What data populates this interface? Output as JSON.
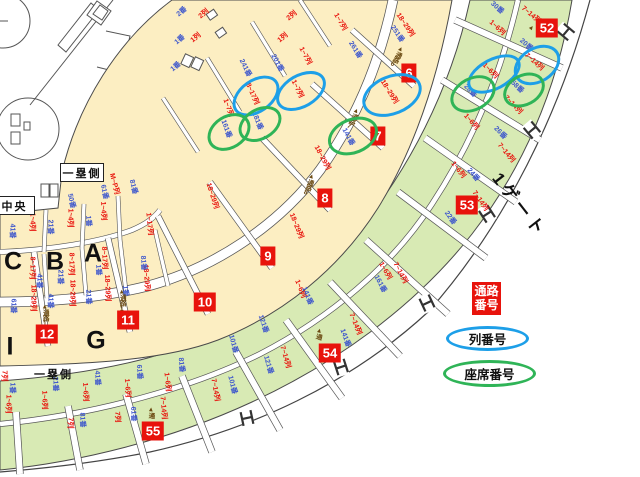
{
  "legend": {
    "aisle_label": "通路番号",
    "row_label": "列番号",
    "seat_label": "座席番号"
  },
  "gate_label": "1ゲート",
  "area_labels": {
    "first_base_upper": "一塁側",
    "first_base_lower": "一塁側",
    "center": "中央"
  },
  "section_letters": [
    {
      "t": "C",
      "x": 13,
      "y": 262
    },
    {
      "t": "B",
      "x": 55,
      "y": 262
    },
    {
      "t": "A",
      "x": 93,
      "y": 254
    },
    {
      "t": "I",
      "x": 10,
      "y": 347
    },
    {
      "t": "G",
      "x": 96,
      "y": 341
    }
  ],
  "aisle_badges": [
    {
      "t": "6",
      "x": 409,
      "y": 73
    },
    {
      "t": "7",
      "x": 378,
      "y": 136
    },
    {
      "t": "8",
      "x": 325,
      "y": 198
    },
    {
      "t": "9",
      "x": 268,
      "y": 256
    },
    {
      "t": "10",
      "x": 205,
      "y": 302
    },
    {
      "t": "11",
      "x": 128,
      "y": 320
    },
    {
      "t": "12",
      "x": 47,
      "y": 334
    },
    {
      "t": "52",
      "x": 547,
      "y": 28
    },
    {
      "t": "53",
      "x": 467,
      "y": 205
    },
    {
      "t": "54",
      "x": 330,
      "y": 353
    },
    {
      "t": "55",
      "x": 153,
      "y": 431
    }
  ],
  "highlight_ovals": [
    {
      "c": "blue",
      "x": 253,
      "y": 93,
      "w": 46,
      "h": 28,
      "r": -35
    },
    {
      "c": "blue",
      "x": 298,
      "y": 88,
      "w": 48,
      "h": 28,
      "r": -30
    },
    {
      "c": "blue",
      "x": 389,
      "y": 92,
      "w": 56,
      "h": 34,
      "r": -22
    },
    {
      "c": "blue",
      "x": 491,
      "y": 71,
      "w": 52,
      "h": 26,
      "r": -28
    },
    {
      "c": "blue",
      "x": 534,
      "y": 62,
      "w": 44,
      "h": 30,
      "r": -32
    },
    {
      "c": "green",
      "x": 226,
      "y": 129,
      "w": 40,
      "h": 28,
      "r": -32
    },
    {
      "c": "green",
      "x": 257,
      "y": 121,
      "w": 40,
      "h": 26,
      "r": -30
    },
    {
      "c": "green",
      "x": 350,
      "y": 133,
      "w": 46,
      "h": 30,
      "r": -22
    },
    {
      "c": "green",
      "x": 470,
      "y": 91,
      "w": 42,
      "h": 28,
      "r": -28
    },
    {
      "c": "green",
      "x": 521,
      "y": 87,
      "w": 38,
      "h": 26,
      "r": -28
    }
  ],
  "labels": [
    {
      "t": "1~4列",
      "x": 32,
      "y": 222,
      "r": 90,
      "k": "r"
    },
    {
      "t": "1~4列",
      "x": 70,
      "y": 218,
      "r": 90,
      "k": "r"
    },
    {
      "t": "1~4列",
      "x": 103,
      "y": 211,
      "r": 88,
      "k": "r"
    },
    {
      "t": "8~17列",
      "x": 32,
      "y": 268,
      "r": 90,
      "k": "r"
    },
    {
      "t": "8~17列",
      "x": 71,
      "y": 264,
      "r": 90,
      "k": "r"
    },
    {
      "t": "8~17列",
      "x": 104,
      "y": 258,
      "r": 88,
      "k": "r"
    },
    {
      "t": "18~29列",
      "x": 33,
      "y": 298,
      "r": 90,
      "k": "r"
    },
    {
      "t": "18~29列",
      "x": 72,
      "y": 293,
      "r": 90,
      "k": "r"
    },
    {
      "t": "18~29列",
      "x": 107,
      "y": 288,
      "r": 88,
      "k": "r"
    },
    {
      "t": "18~29列",
      "x": 146,
      "y": 278,
      "r": 86,
      "k": "r"
    },
    {
      "t": "M~P列",
      "x": 114,
      "y": 184,
      "r": 76,
      "k": "r"
    },
    {
      "t": "1~17列",
      "x": 149,
      "y": 224,
      "r": 84,
      "k": "r"
    },
    {
      "t": "1~7列",
      "x": 228,
      "y": 108,
      "r": 70,
      "k": "r"
    },
    {
      "t": "8~17列",
      "x": 252,
      "y": 94,
      "r": 66,
      "k": "r"
    },
    {
      "t": "1~7列",
      "x": 297,
      "y": 89,
      "r": 64,
      "k": "r"
    },
    {
      "t": "18~29列",
      "x": 389,
      "y": 92,
      "r": 58,
      "k": "r"
    },
    {
      "t": "18~29列",
      "x": 322,
      "y": 158,
      "r": 62,
      "k": "r"
    },
    {
      "t": "18~29列",
      "x": 296,
      "y": 226,
      "r": 68,
      "k": "r"
    },
    {
      "t": "18~29列",
      "x": 212,
      "y": 196,
      "r": 72,
      "k": "r"
    },
    {
      "t": "1~7列",
      "x": 340,
      "y": 22,
      "r": 60,
      "k": "r"
    },
    {
      "t": "1~7列",
      "x": 305,
      "y": 56,
      "r": 62,
      "k": "r"
    },
    {
      "t": "18~29列",
      "x": 405,
      "y": 25,
      "r": 56,
      "k": "r"
    },
    {
      "t": "1~6列",
      "x": 497,
      "y": 28,
      "r": 42,
      "k": "r"
    },
    {
      "t": "1~6列",
      "x": 490,
      "y": 71,
      "r": 45,
      "k": "r"
    },
    {
      "t": "1~6列",
      "x": 471,
      "y": 122,
      "r": 48,
      "k": "r"
    },
    {
      "t": "1~6列",
      "x": 458,
      "y": 170,
      "r": 52,
      "k": "r"
    },
    {
      "t": "1~6列",
      "x": 385,
      "y": 271,
      "r": 60,
      "k": "r"
    },
    {
      "t": "1~6列",
      "x": 300,
      "y": 289,
      "r": 68,
      "k": "r"
    },
    {
      "t": "1~6列",
      "x": 167,
      "y": 382,
      "r": 84,
      "k": "r"
    },
    {
      "t": "1~6列",
      "x": 127,
      "y": 388,
      "r": 86,
      "k": "r"
    },
    {
      "t": "1~6列",
      "x": 85,
      "y": 392,
      "r": 88,
      "k": "r"
    },
    {
      "t": "1~6列",
      "x": 44,
      "y": 400,
      "r": 89,
      "k": "r"
    },
    {
      "t": "1~6列",
      "x": 8,
      "y": 404,
      "r": 90,
      "k": "r"
    },
    {
      "t": "7~14列",
      "x": 531,
      "y": 15,
      "r": 40,
      "k": "r"
    },
    {
      "t": "7~14列",
      "x": 534,
      "y": 62,
      "r": 42,
      "k": "r"
    },
    {
      "t": "7~14列",
      "x": 513,
      "y": 105,
      "r": 46,
      "k": "r"
    },
    {
      "t": "7~14列",
      "x": 506,
      "y": 153,
      "r": 50,
      "k": "r"
    },
    {
      "t": "7~14列",
      "x": 480,
      "y": 201,
      "r": 55,
      "k": "r"
    },
    {
      "t": "7~14列",
      "x": 400,
      "y": 273,
      "r": 62,
      "k": "r"
    },
    {
      "t": "7~14列",
      "x": 355,
      "y": 324,
      "r": 68,
      "k": "r"
    },
    {
      "t": "7~14列",
      "x": 285,
      "y": 357,
      "r": 74,
      "k": "r"
    },
    {
      "t": "7~14列",
      "x": 215,
      "y": 390,
      "r": 80,
      "k": "r"
    },
    {
      "t": "7~14列",
      "x": 163,
      "y": 408,
      "r": 85,
      "k": "r"
    },
    {
      "t": "7列",
      "x": 70,
      "y": 423,
      "r": 90,
      "k": "r"
    },
    {
      "t": "7列",
      "x": 117,
      "y": 417,
      "r": 88,
      "k": "r"
    },
    {
      "t": "7列",
      "x": 4,
      "y": 376,
      "r": 90,
      "k": "r"
    },
    {
      "t": "41番",
      "x": 12,
      "y": 231,
      "r": 90,
      "k": "b"
    },
    {
      "t": "21番",
      "x": 50,
      "y": 227,
      "r": 90,
      "k": "b"
    },
    {
      "t": "1番",
      "x": 88,
      "y": 221,
      "r": 88,
      "k": "b"
    },
    {
      "t": "50番",
      "x": 71,
      "y": 201,
      "r": 78,
      "k": "b"
    },
    {
      "t": "41番",
      "x": 39,
      "y": 281,
      "r": 90,
      "k": "b"
    },
    {
      "t": "21番",
      "x": 60,
      "y": 277,
      "r": 90,
      "k": "b"
    },
    {
      "t": "1番",
      "x": 98,
      "y": 270,
      "r": 88,
      "k": "b"
    },
    {
      "t": "81番",
      "x": 143,
      "y": 263,
      "r": 86,
      "k": "b"
    },
    {
      "t": "61番",
      "x": 104,
      "y": 192,
      "r": 78,
      "k": "b"
    },
    {
      "t": "81番",
      "x": 133,
      "y": 187,
      "r": 76,
      "k": "b"
    },
    {
      "t": "61番",
      "x": 13,
      "y": 306,
      "r": 90,
      "k": "b"
    },
    {
      "t": "41番",
      "x": 50,
      "y": 301,
      "r": 90,
      "k": "b"
    },
    {
      "t": "21番",
      "x": 88,
      "y": 297,
      "r": 88,
      "k": "b"
    },
    {
      "t": "1番",
      "x": 125,
      "y": 291,
      "r": 86,
      "k": "b"
    },
    {
      "t": "2番",
      "x": 182,
      "y": 12,
      "r": -40,
      "k": "b"
    },
    {
      "t": "1番",
      "x": 180,
      "y": 40,
      "r": -40,
      "k": "b"
    },
    {
      "t": "1番",
      "x": 176,
      "y": 67,
      "r": -40,
      "k": "b"
    },
    {
      "t": "1列",
      "x": 196,
      "y": 38,
      "r": -40,
      "k": "r"
    },
    {
      "t": "2列",
      "x": 204,
      "y": 14,
      "r": -40,
      "k": "r"
    },
    {
      "t": "1列",
      "x": 283,
      "y": 38,
      "r": -40,
      "k": "r"
    },
    {
      "t": "2列",
      "x": 292,
      "y": 16,
      "r": -40,
      "k": "r"
    },
    {
      "t": "201番",
      "x": 277,
      "y": 63,
      "r": 62,
      "k": "b"
    },
    {
      "t": "241番",
      "x": 245,
      "y": 68,
      "r": 64,
      "k": "b"
    },
    {
      "t": "261番",
      "x": 355,
      "y": 50,
      "r": 58,
      "k": "b"
    },
    {
      "t": "251番",
      "x": 397,
      "y": 34,
      "r": 56,
      "k": "b"
    },
    {
      "t": "161番",
      "x": 226,
      "y": 129,
      "r": 70,
      "k": "b"
    },
    {
      "t": "181番",
      "x": 257,
      "y": 121,
      "r": 68,
      "k": "b"
    },
    {
      "t": "141番",
      "x": 348,
      "y": 137,
      "r": 62,
      "k": "b"
    },
    {
      "t": "30番",
      "x": 497,
      "y": 8,
      "r": 42,
      "k": "b"
    },
    {
      "t": "20番",
      "x": 526,
      "y": 45,
      "r": 42,
      "k": "b"
    },
    {
      "t": "28番",
      "x": 470,
      "y": 91,
      "r": 46,
      "k": "b"
    },
    {
      "t": "58番",
      "x": 517,
      "y": 87,
      "r": 44,
      "k": "b"
    },
    {
      "t": "26番",
      "x": 500,
      "y": 133,
      "r": 46,
      "k": "b"
    },
    {
      "t": "24番",
      "x": 473,
      "y": 175,
      "r": 50,
      "k": "b"
    },
    {
      "t": "22番",
      "x": 450,
      "y": 218,
      "r": 54,
      "k": "b"
    },
    {
      "t": "161番",
      "x": 380,
      "y": 284,
      "r": 62,
      "k": "b"
    },
    {
      "t": "141番",
      "x": 307,
      "y": 296,
      "r": 68,
      "k": "b"
    },
    {
      "t": "121番",
      "x": 263,
      "y": 324,
      "r": 72,
      "k": "b"
    },
    {
      "t": "101番",
      "x": 233,
      "y": 344,
      "r": 75,
      "k": "b"
    },
    {
      "t": "121番",
      "x": 268,
      "y": 365,
      "r": 74,
      "k": "b"
    },
    {
      "t": "101番",
      "x": 232,
      "y": 385,
      "r": 76,
      "k": "b"
    },
    {
      "t": "141番",
      "x": 345,
      "y": 338,
      "r": 70,
      "k": "b"
    },
    {
      "t": "1番",
      "x": 12,
      "y": 388,
      "r": 90,
      "k": "b"
    },
    {
      "t": "21番",
      "x": 55,
      "y": 384,
      "r": 89,
      "k": "b"
    },
    {
      "t": "41番",
      "x": 97,
      "y": 378,
      "r": 88,
      "k": "b"
    },
    {
      "t": "61番",
      "x": 139,
      "y": 372,
      "r": 86,
      "k": "b"
    },
    {
      "t": "81番",
      "x": 181,
      "y": 365,
      "r": 84,
      "k": "b"
    },
    {
      "t": "81番",
      "x": 82,
      "y": 420,
      "r": 88,
      "k": "b"
    },
    {
      "t": "61番",
      "x": 133,
      "y": 414,
      "r": 87,
      "k": "b"
    },
    {
      "t": "▲通路12",
      "x": 44,
      "y": 318,
      "r": 0,
      "k": "m"
    },
    {
      "t": "▲通路11",
      "x": 121,
      "y": 303,
      "r": 0,
      "k": "m"
    },
    {
      "t": "▲通路8",
      "x": 308,
      "y": 184,
      "r": 20,
      "k": "m"
    },
    {
      "t": "▲通路7",
      "x": 352,
      "y": 118,
      "r": 25,
      "k": "m"
    },
    {
      "t": "▲通路6",
      "x": 396,
      "y": 56,
      "r": 28,
      "k": "m"
    },
    {
      "t": "▲通",
      "x": 318,
      "y": 333,
      "r": 15,
      "k": "m"
    },
    {
      "t": "▲通",
      "x": 150,
      "y": 412,
      "r": 5,
      "k": "m"
    },
    {
      "t": "▲",
      "x": 531,
      "y": 27,
      "r": 40,
      "k": "m"
    }
  ],
  "colors": {
    "aisle_badge_red": "#e8130c",
    "row_oval_blue": "#1d9fe8",
    "seat_oval_green": "#2fb457",
    "seat_text_blue": "#3e57cc",
    "row_text_red": "#e8130c",
    "inner_seating_cream": "#fceec2",
    "outer_seating_green": "#d8eab4"
  }
}
